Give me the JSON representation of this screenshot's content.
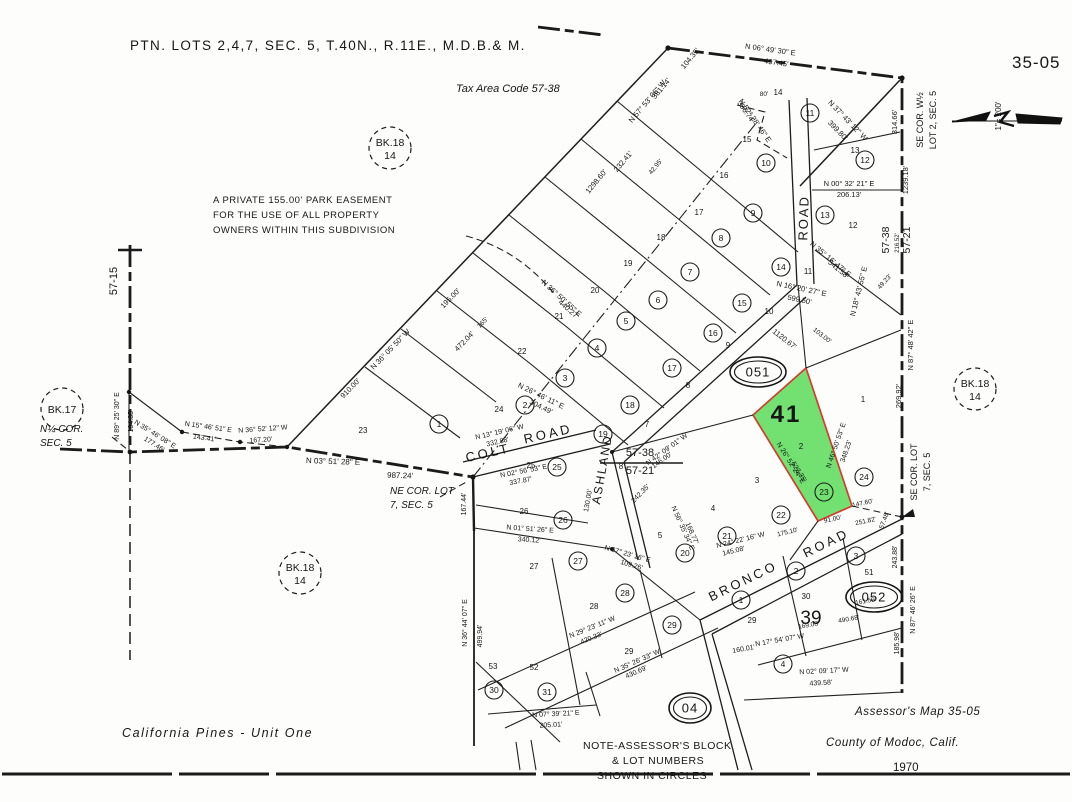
{
  "page": {
    "title": "PTN. LOTS 2,4,7, SEC. 5, T.40N., R.11E., M.D.B.& M.",
    "tax_area_code": "Tax Area Code 57-38",
    "sheet_number": "35-05",
    "scale_label": "1\"= 200'",
    "subdivision_name": "California  Pines - Unit  One",
    "credit_line1": "Assessor's Map 35-05",
    "credit_line2": "County of Modoc, Calif.",
    "credit_line3": "1970"
  },
  "highlight_parcel": {
    "block": "051",
    "label": "41",
    "x": 786,
    "y": 422,
    "lot_number": "2",
    "circled_number": "23",
    "fill": "#5fdd5f",
    "border": "#d43c2c",
    "label_color": "#0c9a0c"
  },
  "book_circles": [
    {
      "line1": "BK.18",
      "line2": "14",
      "x": 390,
      "y": 148
    },
    {
      "line1": "BK.18",
      "line2": "14",
      "x": 975,
      "y": 389
    },
    {
      "line1": "BK.18",
      "line2": "14",
      "x": 300,
      "y": 573
    },
    {
      "line1": "BK.17",
      "line2": "",
      "x": 62,
      "y": 409
    }
  ],
  "block_ovals": [
    {
      "label": "051",
      "x": 758,
      "y": 372
    },
    {
      "label": "052",
      "x": 874,
      "y": 597
    },
    {
      "label": "04",
      "x": 690,
      "y": 708
    }
  ],
  "feature_numbers": [
    {
      "t": "39",
      "x": 811,
      "y": 624,
      "s": 19
    }
  ],
  "roads": [
    {
      "t": "COLT",
      "x": 489,
      "y": 457,
      "r": -13,
      "s": 13,
      "ls": 3
    },
    {
      "t": "ROAD",
      "x": 549,
      "y": 438,
      "r": -13,
      "s": 13,
      "ls": 3
    },
    {
      "t": "ASHLAND",
      "x": 606,
      "y": 470,
      "r": -80,
      "s": 12,
      "ls": 2
    },
    {
      "t": "ROAD",
      "x": 808,
      "y": 218,
      "r": -88,
      "s": 13,
      "ls": 2
    },
    {
      "t": "BRONCO",
      "x": 745,
      "y": 585,
      "r": -26,
      "s": 13,
      "ls": 3
    },
    {
      "t": "ROAD",
      "x": 828,
      "y": 547,
      "r": -26,
      "s": 13,
      "ls": 3
    }
  ],
  "circled_lots": [
    {
      "n": "11",
      "x": 810,
      "y": 113
    },
    {
      "n": "10",
      "x": 766,
      "y": 163
    },
    {
      "n": "12",
      "x": 865,
      "y": 160
    },
    {
      "n": "13",
      "x": 825,
      "y": 215
    },
    {
      "n": "9",
      "x": 753,
      "y": 213
    },
    {
      "n": "8",
      "x": 721,
      "y": 238
    },
    {
      "n": "14",
      "x": 781,
      "y": 267
    },
    {
      "n": "7",
      "x": 690,
      "y": 272
    },
    {
      "n": "15",
      "x": 742,
      "y": 303
    },
    {
      "n": "16",
      "x": 713,
      "y": 333
    },
    {
      "n": "6",
      "x": 658,
      "y": 300
    },
    {
      "n": "5",
      "x": 626,
      "y": 321
    },
    {
      "n": "17",
      "x": 672,
      "y": 368
    },
    {
      "n": "4",
      "x": 597,
      "y": 348
    },
    {
      "n": "3",
      "x": 565,
      "y": 378
    },
    {
      "n": "18",
      "x": 630,
      "y": 405
    },
    {
      "n": "2",
      "x": 525,
      "y": 405
    },
    {
      "n": "1",
      "x": 439,
      "y": 424
    },
    {
      "n": "19",
      "x": 603,
      "y": 434
    },
    {
      "n": "25",
      "x": 557,
      "y": 467
    },
    {
      "n": "26",
      "x": 563,
      "y": 520
    },
    {
      "n": "27",
      "x": 578,
      "y": 561
    },
    {
      "n": "28",
      "x": 625,
      "y": 593
    },
    {
      "n": "29",
      "x": 672,
      "y": 625
    },
    {
      "n": "20",
      "x": 685,
      "y": 553
    },
    {
      "n": "21",
      "x": 727,
      "y": 536
    },
    {
      "n": "22",
      "x": 781,
      "y": 515
    },
    {
      "n": "23",
      "x": 824,
      "y": 492
    },
    {
      "n": "24",
      "x": 864,
      "y": 477
    },
    {
      "n": "30",
      "x": 494,
      "y": 690
    },
    {
      "n": "31",
      "x": 547,
      "y": 692
    },
    {
      "n": "1",
      "x": 741,
      "y": 600
    },
    {
      "n": "2",
      "x": 796,
      "y": 571
    },
    {
      "n": "3",
      "x": 856,
      "y": 556
    },
    {
      "n": "4",
      "x": 783,
      "y": 664
    }
  ],
  "lot_numbers": [
    {
      "n": "14",
      "x": 778,
      "y": 95
    },
    {
      "n": "13",
      "x": 855,
      "y": 153
    },
    {
      "n": "12",
      "x": 853,
      "y": 228
    },
    {
      "n": "11",
      "x": 808,
      "y": 274
    },
    {
      "n": "10",
      "x": 769,
      "y": 314
    },
    {
      "n": "9",
      "x": 728,
      "y": 348
    },
    {
      "n": "8",
      "x": 688,
      "y": 388
    },
    {
      "n": "7",
      "x": 647,
      "y": 427
    },
    {
      "n": "15",
      "x": 747,
      "y": 142
    },
    {
      "n": "16",
      "x": 724,
      "y": 178
    },
    {
      "n": "17",
      "x": 699,
      "y": 215
    },
    {
      "n": "18",
      "x": 661,
      "y": 240
    },
    {
      "n": "19",
      "x": 628,
      "y": 266
    },
    {
      "n": "20",
      "x": 595,
      "y": 293
    },
    {
      "n": "21",
      "x": 559,
      "y": 319
    },
    {
      "n": "22",
      "x": 522,
      "y": 354
    },
    {
      "n": "23",
      "x": 363,
      "y": 433
    },
    {
      "n": "24",
      "x": 499,
      "y": 412
    },
    {
      "n": "25",
      "x": 531,
      "y": 468
    },
    {
      "n": "26",
      "x": 524,
      "y": 514
    },
    {
      "n": "27",
      "x": 534,
      "y": 569
    },
    {
      "n": "28",
      "x": 594,
      "y": 609
    },
    {
      "n": "29",
      "x": 629,
      "y": 654
    },
    {
      "n": "8",
      "x": 621,
      "y": 469
    },
    {
      "n": "1",
      "x": 863,
      "y": 402
    },
    {
      "n": "2",
      "x": 801,
      "y": 449
    },
    {
      "n": "3",
      "x": 757,
      "y": 483
    },
    {
      "n": "4",
      "x": 713,
      "y": 511
    },
    {
      "n": "5",
      "x": 660,
      "y": 538
    },
    {
      "n": "30",
      "x": 806,
      "y": 599
    },
    {
      "n": "51",
      "x": 869,
      "y": 575
    },
    {
      "n": "52",
      "x": 534,
      "y": 670
    },
    {
      "n": "53",
      "x": 493,
      "y": 669
    },
    {
      "n": "29",
      "x": 752,
      "y": 623
    }
  ],
  "survey_labels": [
    {
      "t": "N 06° 49' 30\" E",
      "x": 770,
      "y": 52,
      "r": 8
    },
    {
      "t": "497.45'",
      "x": 776,
      "y": 65,
      "r": 8
    },
    {
      "t": "N 57° 53' 06\" W",
      "x": 649,
      "y": 103,
      "r": -50
    },
    {
      "t": "381.14'",
      "x": 663,
      "y": 90,
      "r": -50
    },
    {
      "t": "104.35'",
      "x": 692,
      "y": 60,
      "r": -50
    },
    {
      "t": "N 52° 28' 46\" E",
      "x": 753,
      "y": 122,
      "r": 55
    },
    {
      "t": "396.74'",
      "x": 744,
      "y": 113,
      "r": 55
    },
    {
      "t": "80'",
      "x": 764,
      "y": 96,
      "r": 0,
      "s": 6.5
    },
    {
      "t": "N 37° 43' 12\" W",
      "x": 846,
      "y": 122,
      "r": 46
    },
    {
      "t": "399.80'",
      "x": 836,
      "y": 132,
      "r": 46
    },
    {
      "t": "314.66'",
      "x": 897,
      "y": 122,
      "r": -90
    },
    {
      "t": "1239.18'",
      "x": 908,
      "y": 180,
      "r": -90
    },
    {
      "t": "N 00° 32' 21\" E",
      "x": 849,
      "y": 186,
      "r": 0
    },
    {
      "t": "206.13'",
      "x": 849,
      "y": 197,
      "r": 0
    },
    {
      "t": "1298.60'",
      "x": 598,
      "y": 183,
      "r": -50
    },
    {
      "t": "232.41'",
      "x": 625,
      "y": 163,
      "r": -50
    },
    {
      "t": "42.95'",
      "x": 657,
      "y": 168,
      "r": -50,
      "s": 6.5
    },
    {
      "t": "N 35° 16' 47\" E",
      "x": 829,
      "y": 261,
      "r": 40
    },
    {
      "t": "541.58'",
      "x": 837,
      "y": 271,
      "r": 40
    },
    {
      "t": "N 16° 20' 27\" E",
      "x": 801,
      "y": 291,
      "r": 12
    },
    {
      "t": "599.50'",
      "x": 799,
      "y": 302,
      "r": 12
    },
    {
      "t": "N 18° 43' 55\" E",
      "x": 861,
      "y": 292,
      "r": -76
    },
    {
      "t": "57-38",
      "x": 889,
      "y": 240,
      "r": -90,
      "s": 10.5
    },
    {
      "t": "216.52'",
      "x": 899,
      "y": 243,
      "r": -90,
      "s": 6
    },
    {
      "t": "57-21",
      "x": 910,
      "y": 240,
      "r": -90,
      "s": 10.5
    },
    {
      "t": "49.23'",
      "x": 886,
      "y": 283,
      "r": -48,
      "s": 6.5
    },
    {
      "t": "N 87° 48' 42\" E",
      "x": 913,
      "y": 345,
      "r": -90
    },
    {
      "t": "269.92'",
      "x": 901,
      "y": 396,
      "r": -90
    },
    {
      "t": "1120.67'",
      "x": 783,
      "y": 341,
      "r": 38
    },
    {
      "t": "103.00'",
      "x": 821,
      "y": 337,
      "r": 38,
      "s": 6.5
    },
    {
      "t": "N 36° 05' 50\" W",
      "x": 392,
      "y": 351,
      "r": -46
    },
    {
      "t": "910.00'",
      "x": 352,
      "y": 390,
      "r": -46
    },
    {
      "t": "195.00'",
      "x": 452,
      "y": 300,
      "r": -46
    },
    {
      "t": "165'",
      "x": 484,
      "y": 324,
      "r": -46,
      "s": 6.5
    },
    {
      "t": "472.04'",
      "x": 466,
      "y": 343,
      "r": -46
    },
    {
      "t": "N 36° 50' 55\" E",
      "x": 560,
      "y": 300,
      "r": 42
    },
    {
      "t": "440.27'",
      "x": 567,
      "y": 311,
      "r": 42
    },
    {
      "t": "N 26° 46' 11\" E",
      "x": 540,
      "y": 398,
      "r": 26
    },
    {
      "t": "304.49'",
      "x": 540,
      "y": 409,
      "r": 26
    },
    {
      "t": "57-15",
      "x": 117,
      "y": 281,
      "r": -90,
      "s": 11
    },
    {
      "t": "N 89° 25' 30\" E",
      "x": 119,
      "y": 416,
      "r": -90,
      "s": 7
    },
    {
      "t": "194.35'",
      "x": 133,
      "y": 421,
      "r": -90,
      "s": 7
    },
    {
      "t": "N 35° 46' 08\" E",
      "x": 154,
      "y": 436,
      "r": 32,
      "s": 7
    },
    {
      "t": "177.46'",
      "x": 153,
      "y": 446,
      "r": 32,
      "s": 7
    },
    {
      "t": "N 15° 46' 51\" E",
      "x": 208,
      "y": 429,
      "r": 8,
      "s": 7
    },
    {
      "t": "143.41'",
      "x": 204,
      "y": 440,
      "r": 8,
      "s": 7
    },
    {
      "t": "N 36° 52' 12\" W",
      "x": 263,
      "y": 431,
      "r": -4,
      "s": 7
    },
    {
      "t": "167.20'",
      "x": 261,
      "y": 442,
      "r": -4,
      "s": 7
    },
    {
      "t": "N 03° 51' 28\" E",
      "x": 333,
      "y": 464,
      "r": 2,
      "s": 8
    },
    {
      "t": "987.24'",
      "x": 400,
      "y": 478,
      "r": 2,
      "s": 8
    },
    {
      "t": "57-38",
      "x": 640,
      "y": 456,
      "r": 0,
      "s": 11
    },
    {
      "t": "57-21",
      "x": 640,
      "y": 474,
      "r": 0,
      "s": 11
    },
    {
      "t": "N 13° 19' 06\" W",
      "x": 500,
      "y": 434,
      "r": -13,
      "s": 7
    },
    {
      "t": "332.88'",
      "x": 498,
      "y": 444,
      "r": -13,
      "s": 7
    },
    {
      "t": "N 02° 56' 53\" E",
      "x": 524,
      "y": 473,
      "r": -11,
      "s": 7
    },
    {
      "t": "337.87'",
      "x": 521,
      "y": 483,
      "r": -11,
      "s": 7
    },
    {
      "t": "N 01° 51' 26\" E",
      "x": 530,
      "y": 531,
      "r": 4,
      "s": 7
    },
    {
      "t": "340.12'",
      "x": 529,
      "y": 542,
      "r": 4,
      "s": 7
    },
    {
      "t": "167.44'",
      "x": 466,
      "y": 504,
      "r": -90,
      "s": 7
    },
    {
      "t": "N 42° 09' 01\" W",
      "x": 668,
      "y": 451,
      "r": -36,
      "s": 7
    },
    {
      "t": "146.00'",
      "x": 663,
      "y": 462,
      "r": -36,
      "s": 7
    },
    {
      "t": "242.35'",
      "x": 642,
      "y": 495,
      "r": -46,
      "s": 7
    },
    {
      "t": "130.00'",
      "x": 590,
      "y": 501,
      "r": -80,
      "s": 7
    },
    {
      "t": "N 56° 35' 34\" E",
      "x": 681,
      "y": 529,
      "r": 66,
      "s": 7
    },
    {
      "t": "168.77'",
      "x": 690,
      "y": 534,
      "r": 66,
      "s": 7
    },
    {
      "t": "N 46° 50' 53\" E",
      "x": 838,
      "y": 446,
      "r": -71,
      "s": 7
    },
    {
      "t": "348.23'",
      "x": 848,
      "y": 452,
      "r": -71,
      "s": 7
    },
    {
      "t": "N 26° 52' 24\" E",
      "x": 789,
      "y": 464,
      "r": 58,
      "s": 7
    },
    {
      "t": "523.35'",
      "x": 797,
      "y": 473,
      "r": 58,
      "s": 7
    },
    {
      "t": "91.00'",
      "x": 833,
      "y": 521,
      "r": -12,
      "s": 6.5
    },
    {
      "t": "147.60'",
      "x": 863,
      "y": 505,
      "r": -12,
      "s": 6.5
    },
    {
      "t": "251.82'",
      "x": 866,
      "y": 523,
      "r": -12,
      "s": 6.5
    },
    {
      "t": "57.48'",
      "x": 886,
      "y": 521,
      "r": -70,
      "s": 6.5
    },
    {
      "t": "N 24° 22' 16\" W",
      "x": 741,
      "y": 542,
      "r": -14,
      "s": 7
    },
    {
      "t": "145.08'",
      "x": 734,
      "y": 553,
      "r": -14,
      "s": 7
    },
    {
      "t": "175.10'",
      "x": 788,
      "y": 534,
      "r": -14,
      "s": 6.5
    },
    {
      "t": "N 37° 23' 16\" E",
      "x": 627,
      "y": 556,
      "r": 16,
      "s": 7
    },
    {
      "t": "109.26'",
      "x": 631,
      "y": 567,
      "r": 16,
      "s": 7
    },
    {
      "t": "N 29° 23' 11\" W",
      "x": 593,
      "y": 629,
      "r": -22,
      "s": 7
    },
    {
      "t": "420.33'",
      "x": 592,
      "y": 640,
      "r": -22,
      "s": 7
    },
    {
      "t": "N 35° 26' 33\" W",
      "x": 638,
      "y": 663,
      "r": -24,
      "s": 7
    },
    {
      "t": "430.69'",
      "x": 637,
      "y": 674,
      "r": -24,
      "s": 7
    },
    {
      "t": "N 07° 39' 21\" E",
      "x": 556,
      "y": 716,
      "r": -3,
      "s": 7
    },
    {
      "t": "205.01'",
      "x": 551,
      "y": 727,
      "r": -3,
      "s": 7
    },
    {
      "t": "N 36° 44' 07\" E",
      "x": 467,
      "y": 623,
      "r": -90,
      "s": 7
    },
    {
      "t": "499.94'",
      "x": 482,
      "y": 636,
      "r": -90,
      "s": 7
    },
    {
      "t": "N 17° 54' 07\" W",
      "x": 780,
      "y": 642,
      "r": -10,
      "s": 7
    },
    {
      "t": "160.01'",
      "x": 744,
      "y": 651,
      "r": -10,
      "s": 7
    },
    {
      "t": "169.08'",
      "x": 809,
      "y": 627,
      "r": -10,
      "s": 6.5
    },
    {
      "t": "490.68'",
      "x": 849,
      "y": 621,
      "r": -10,
      "s": 6.5
    },
    {
      "t": "161.59'",
      "x": 866,
      "y": 603,
      "r": -10,
      "s": 6.5
    },
    {
      "t": "N 02° 09' 17\" W",
      "x": 824,
      "y": 673,
      "r": -3,
      "s": 7
    },
    {
      "t": "439.58'",
      "x": 821,
      "y": 685,
      "r": -3,
      "s": 7
    },
    {
      "t": "N 87° 46' 26\" E",
      "x": 915,
      "y": 610,
      "r": -90,
      "s": 7
    },
    {
      "t": "243.88'",
      "x": 897,
      "y": 557,
      "r": -90,
      "s": 7
    },
    {
      "t": "185.98'",
      "x": 899,
      "y": 643,
      "r": -90,
      "s": 7
    },
    {
      "t": "1\"= 200'",
      "x": 1001,
      "y": 116,
      "r": -90,
      "s": 8
    }
  ],
  "text_blocks": [
    {
      "name": "map-title",
      "x": 130,
      "y": 50,
      "s": 13.5,
      "ls": 1.4,
      "a": "start",
      "lines": [
        "PTN. LOTS 2,4,7, SEC. 5, T.40N., R.11E., M.D.B.& M."
      ]
    },
    {
      "name": "tax-area-code",
      "x": 456,
      "y": 92,
      "s": 11,
      "a": "start",
      "i": true,
      "lines": [
        "Tax Area Code 57-38"
      ]
    },
    {
      "name": "sheet-number",
      "x": 1012,
      "y": 68,
      "s": 17,
      "ls": 1,
      "a": "start",
      "lines": [
        "35-05"
      ]
    },
    {
      "name": "park-easement-note",
      "x": 213,
      "y": 203,
      "s": 9.5,
      "lh": 15,
      "ls": 0.5,
      "a": "start",
      "lines": [
        "A PRIVATE 155.00' PARK EASEMENT",
        "FOR THE USE OF ALL PROPERTY",
        "OWNERS WITHIN THIS SUBDIVISION"
      ]
    },
    {
      "name": "quarter-corner-note",
      "x": 40,
      "y": 432,
      "s": 10,
      "lh": 14,
      "a": "start",
      "i": true,
      "lines": [
        "N¼ COR.",
        "SEC. 5"
      ]
    },
    {
      "name": "ne-corner-note",
      "x": 390,
      "y": 494,
      "s": 10,
      "lh": 14,
      "a": "start",
      "i": true,
      "lines": [
        "NE COR. LOT",
        "7, SEC. 5"
      ]
    },
    {
      "name": "se-corner-lot7-note",
      "x": 917,
      "y": 472,
      "s": 9,
      "r": -90,
      "a": "middle",
      "lines": [
        "SE COR. LOT",
        "7, SEC. 5"
      ]
    },
    {
      "name": "se-corner-w2-note",
      "x": 923,
      "y": 120,
      "s": 9,
      "r": -90,
      "a": "middle",
      "lines": [
        "SE COR. W½",
        "LOT 2, SEC. 5"
      ]
    },
    {
      "name": "subdivision-name",
      "x": 122,
      "y": 737,
      "s": 12.5,
      "ls": 1.6,
      "i": true,
      "a": "start",
      "lines": [
        "California  Pines - Unit  One"
      ]
    },
    {
      "name": "assessor-note-line1",
      "x": 583,
      "y": 749,
      "s": 10.5,
      "ls": 0.5,
      "a": "start",
      "lines": [
        "NOTE-ASSESSOR'S BLOCK"
      ]
    },
    {
      "name": "assessor-note-line2",
      "x": 612,
      "y": 764,
      "s": 10.5,
      "ls": 0.5,
      "a": "start",
      "lines": [
        "& LOT NUMBERS"
      ]
    },
    {
      "name": "assessor-note-line3",
      "x": 597,
      "y": 779,
      "s": 10.5,
      "ls": 0.5,
      "a": "start",
      "lines": [
        "SHOWN IN CIRCLES"
      ]
    },
    {
      "name": "map-credit-title",
      "x": 855,
      "y": 715,
      "s": 11.5,
      "i": true,
      "ls": 0.6,
      "a": "start",
      "lines": [
        "Assessor's Map 35-05"
      ]
    },
    {
      "name": "map-credit-county",
      "x": 826,
      "y": 746,
      "s": 11.5,
      "i": true,
      "ls": 0.6,
      "a": "start",
      "lines": [
        "County of Modoc, Calif."
      ]
    },
    {
      "name": "map-credit-year",
      "x": 893,
      "y": 771,
      "s": 11.5,
      "a": "start",
      "lines": [
        "1970"
      ]
    }
  ]
}
